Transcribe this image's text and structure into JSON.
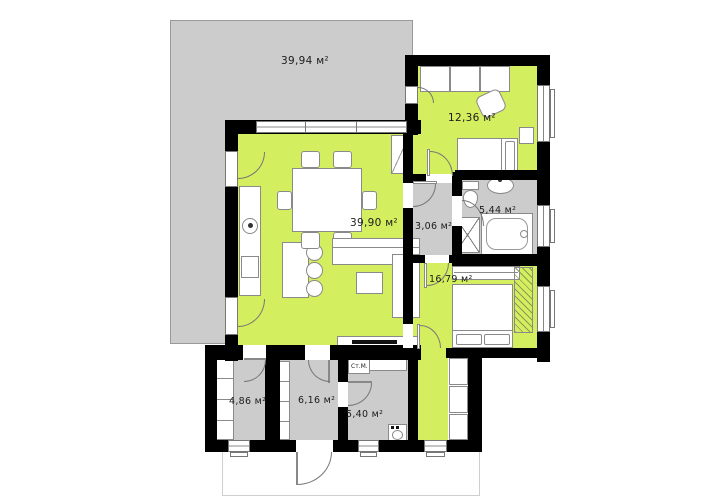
{
  "plan": {
    "colors": {
      "room_accent_green": "#d3ee5e",
      "room_gray": "#cccccc",
      "wall": "#000000"
    },
    "rooms": {
      "terrace": {
        "area": "39,94 м²"
      },
      "living": {
        "area": "39,90 м²"
      },
      "bedroom_top": {
        "area": "12,36 м²"
      },
      "hallway": {
        "area": "3,06 м²"
      },
      "bathroom": {
        "area": "5,44 м²"
      },
      "bedroom_main": {
        "area": "16,79 м²"
      },
      "storage_left": {
        "area": "4,86 м²"
      },
      "storage_mid": {
        "area": "6,16 м²"
      },
      "utility": {
        "area": "5,40 м²"
      }
    },
    "labels": {
      "washing_machine": "Ст.М."
    }
  }
}
